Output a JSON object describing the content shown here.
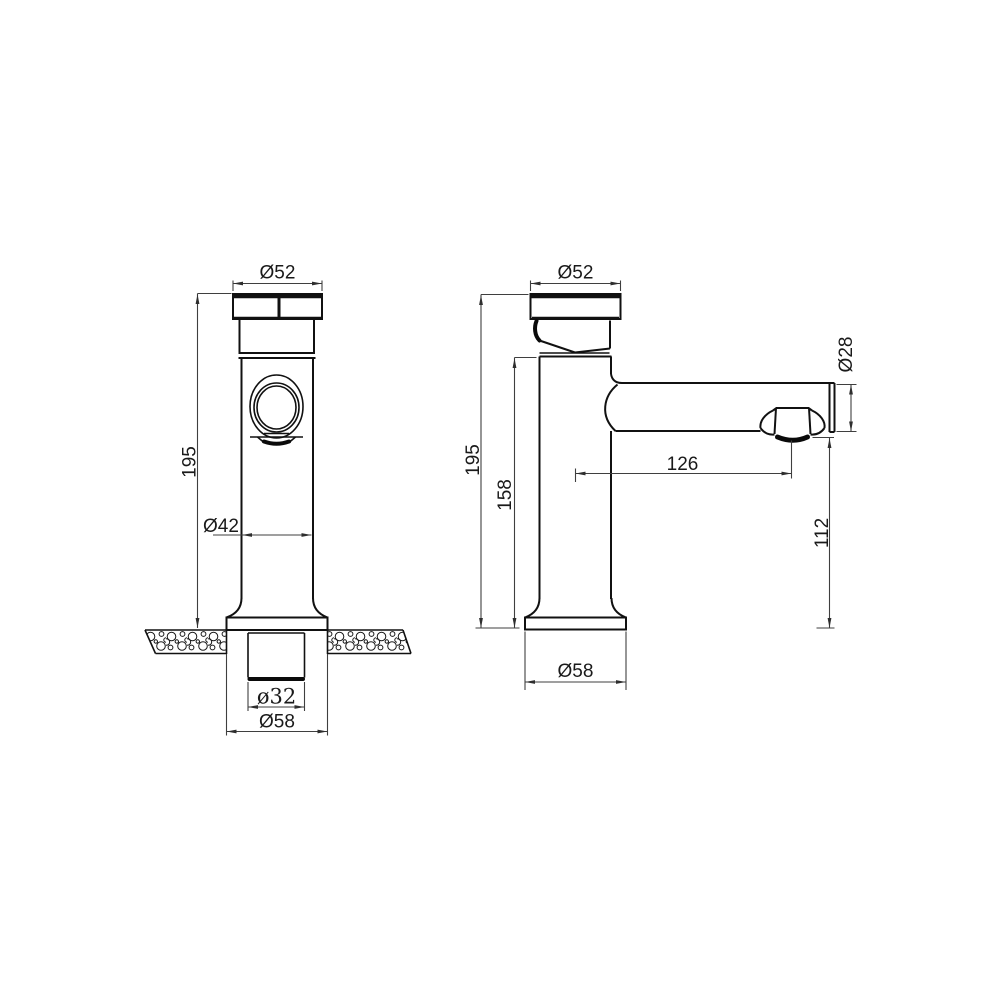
{
  "title": "faucet-dimension-drawing",
  "colors": {
    "background": "#ffffff",
    "object_line": "#111111",
    "dimension_line": "#3f3f3f",
    "text": "#1a1a1a"
  },
  "front_view": {
    "label_cap_diameter": "Ø52",
    "label_overall_height": "195",
    "label_body_diameter": "Ø42",
    "label_shank_diameter": "ø32",
    "label_base_diameter": "Ø58"
  },
  "side_view": {
    "label_cap_diameter": "Ø52",
    "label_overall_height": "195",
    "label_body_height": "158",
    "label_spout_reach": "126",
    "label_spout_diameter": "Ø28",
    "label_outlet_height": "112",
    "label_base_diameter": "Ø58"
  }
}
